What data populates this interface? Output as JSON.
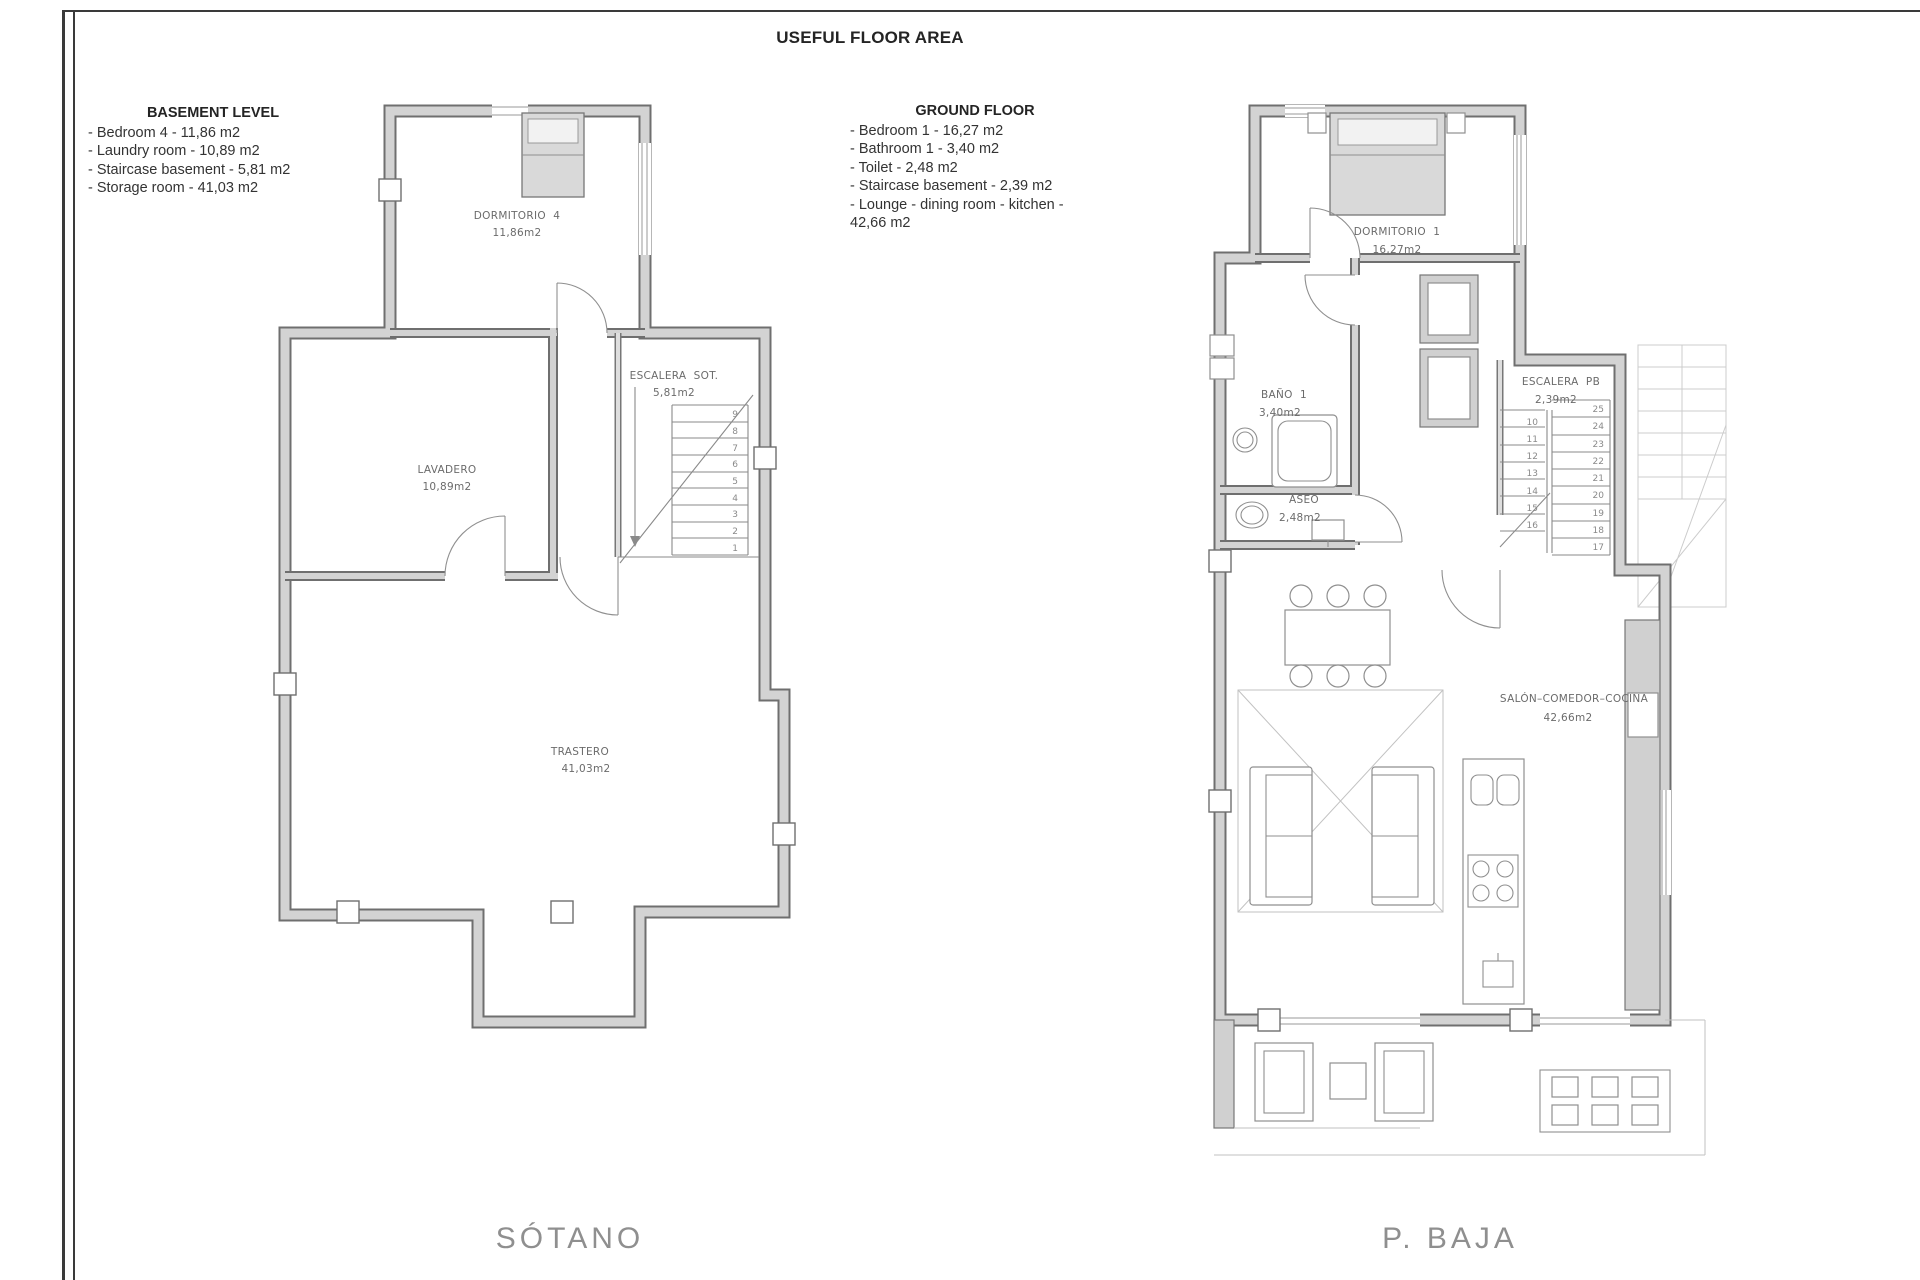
{
  "title": "USEFUL FLOOR AREA",
  "legend_basement": {
    "heading": "BASEMENT LEVEL",
    "items": [
      "- Bedroom 4 - 11,86 m2",
      "- Laundry room - 10,89 m2",
      "- Staircase basement - 5,81 m2",
      "- Storage room - 41,03 m2"
    ]
  },
  "legend_ground": {
    "heading": "GROUND FLOOR",
    "items": [
      "- Bedroom 1 - 16,27 m2",
      "- Bathroom 1 - 3,40 m2",
      "- Toilet - 2,48 m2",
      "- Staircase basement - 2,39 m2",
      "- Lounge - dining room - kitchen - 42,66 m2"
    ]
  },
  "plans": {
    "sotano": {
      "name": "SÓTANO",
      "rooms": {
        "dormitorio4": {
          "label": "DORMITORIO  4",
          "area": "11,86m2"
        },
        "escalera": {
          "label": "ESCALERA  SOT.",
          "area": "5,81m2"
        },
        "lavadero": {
          "label": "LAVADERO",
          "area": "10,89m2"
        },
        "trastero": {
          "label": "TRASTERO",
          "area": "41,03m2"
        }
      },
      "stairs": [
        "9",
        "8",
        "7",
        "6",
        "5",
        "4",
        "3",
        "2",
        "1"
      ]
    },
    "pbaja": {
      "name": "P.  BAJA",
      "rooms": {
        "dormitorio1": {
          "label": "DORMITORIO  1",
          "area": "16,27m2"
        },
        "bano": {
          "label": "BAÑO  1",
          "area": "3,40m2"
        },
        "aseo": {
          "label": "ASEO",
          "area": "2,48m2"
        },
        "escalera": {
          "label": "ESCALERA  PB",
          "area": "2,39m2"
        },
        "salon": {
          "label": "SALÓN–COMEDOR–COCINA",
          "area": "42,66m2"
        }
      },
      "stairs_left": [
        "10",
        "11",
        "12",
        "13",
        "14",
        "15",
        "16"
      ],
      "stairs_right": [
        "25",
        "24",
        "23",
        "22",
        "21",
        "20",
        "19",
        "18",
        "17"
      ]
    }
  },
  "colors": {
    "wall_fill": "#d3d3d3",
    "wall_edge": "#6f6f6f",
    "line_gray": "#8a8a8a",
    "text_dark": "#333333",
    "plan_label_gray": "#8f8f8f",
    "background": "#ffffff"
  }
}
